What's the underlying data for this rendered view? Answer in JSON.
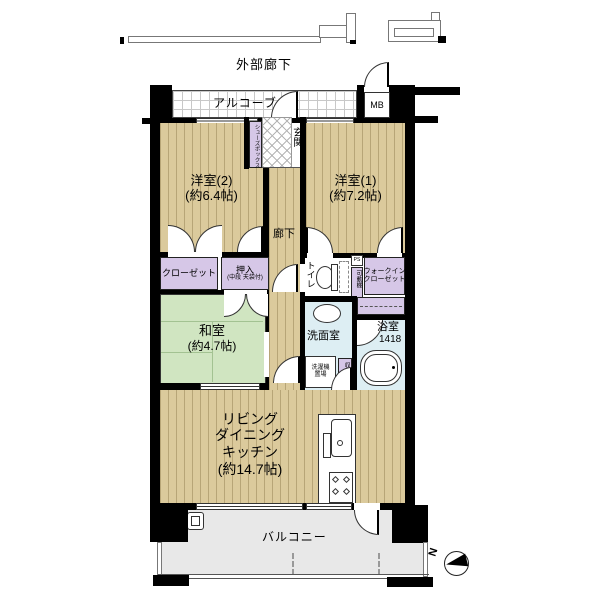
{
  "colors": {
    "wall": "#000000",
    "wood_floor": "#dbca9c",
    "wood_stripe": "#b7a577",
    "tatami_green": "#d0e5c1",
    "closet_purple": "#d6c7e7",
    "wet_area_blue": "#ddeef3",
    "balcony_gray": "#e8e8e8"
  },
  "exterior": {
    "corridor_label": "外部廊下",
    "compass_north": "N"
  },
  "entrance_area": {
    "alcove": "アルコーブ",
    "meter_box": "MB",
    "shoe_box": "シューズボックス",
    "entrance": "玄関"
  },
  "rooms": {
    "west_room_2": {
      "name": "洋室(2)",
      "size": "(約6.4帖)"
    },
    "west_room_1": {
      "name": "洋室(1)",
      "size": "(約7.2帖)"
    },
    "japanese_room": {
      "name": "和室",
      "size": "(約4.7帖)"
    },
    "ldk": {
      "line1": "リビング",
      "line2": "ダイニング",
      "line3": "キッチン",
      "size": "(約14.7帖)"
    },
    "hallway": "廊下",
    "washroom": "洗面室",
    "bathroom": {
      "name": "浴室",
      "size": "1418"
    },
    "toilet": "トイレ",
    "balcony": "バルコニー"
  },
  "storage": {
    "closet": "クローゼット",
    "oshiire": {
      "name": "押入",
      "note": "(中段 天袋付)"
    },
    "walk_in_closet": {
      "line1": "ウォークイン",
      "line2": "クローゼット"
    },
    "movable_shelf": "可動棚",
    "storage_small": "収納",
    "laundry": {
      "line1": "洗濯機",
      "line2": "置場"
    },
    "pipe_space": "PS"
  }
}
